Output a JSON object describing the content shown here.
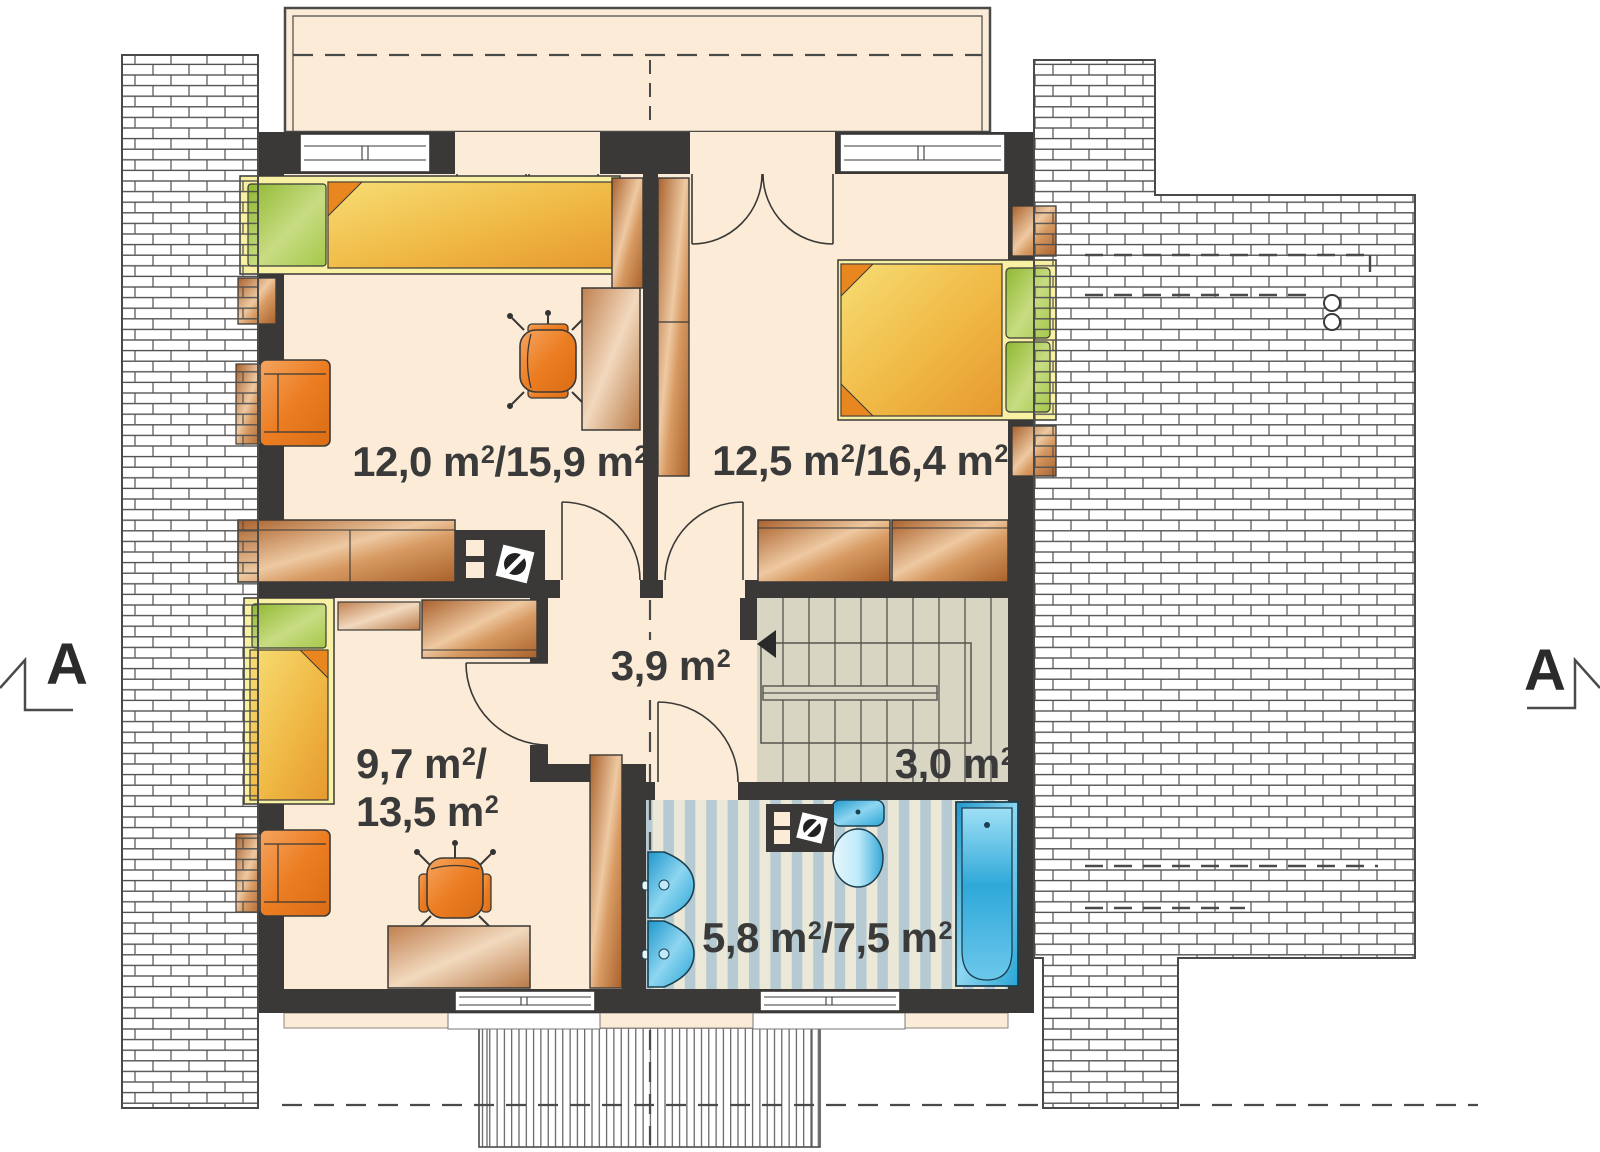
{
  "page": {
    "type": "architectural-floor-plan",
    "floor": "attic-storey"
  },
  "colors": {
    "floor_cream": "#fcecd7",
    "wall_dark": "#3a3937",
    "wood": "#c9854e",
    "stair_floor": "#d9d5c3",
    "bath_stripe_blue": "#b5cad2",
    "bath_stripe_cream": "#ece8d8",
    "fixture_blue": "#3db3e0",
    "bed_yellow": "#f0b945",
    "pillow_green": "#a5c84a",
    "chair_orange": "#ec7d22",
    "line_gray": "#4a4a4a"
  },
  "section_markers": {
    "left": "A",
    "right": "A"
  },
  "rooms": [
    {
      "id": "bedroom-upper-left",
      "area_label": [
        {
          "t": "12,0 m"
        },
        {
          "sup": "2"
        },
        {
          "t": "/15,9 m"
        },
        {
          "sup": "2"
        }
      ]
    },
    {
      "id": "bedroom-upper-right",
      "area_label": [
        {
          "t": "12,5 m"
        },
        {
          "sup": "2"
        },
        {
          "t": "/16,4 m"
        },
        {
          "sup": "2"
        }
      ]
    },
    {
      "id": "hall",
      "area_label": [
        {
          "t": "3,9 m"
        },
        {
          "sup": "2"
        }
      ]
    },
    {
      "id": "staircase",
      "area_label": [
        {
          "t": "3,0 m"
        },
        {
          "sup": "2"
        }
      ]
    },
    {
      "id": "bedroom-lower-left",
      "area_label_line1": [
        {
          "t": "9,7 m"
        },
        {
          "sup": "2"
        },
        {
          "t": "/"
        }
      ],
      "area_label_line2": [
        {
          "t": "13,5 m"
        },
        {
          "sup": "2"
        }
      ]
    },
    {
      "id": "bathroom",
      "area_label": [
        {
          "t": "5,8 m"
        },
        {
          "sup": "2"
        },
        {
          "t": "/7,5 m"
        },
        {
          "sup": "2"
        }
      ]
    }
  ]
}
